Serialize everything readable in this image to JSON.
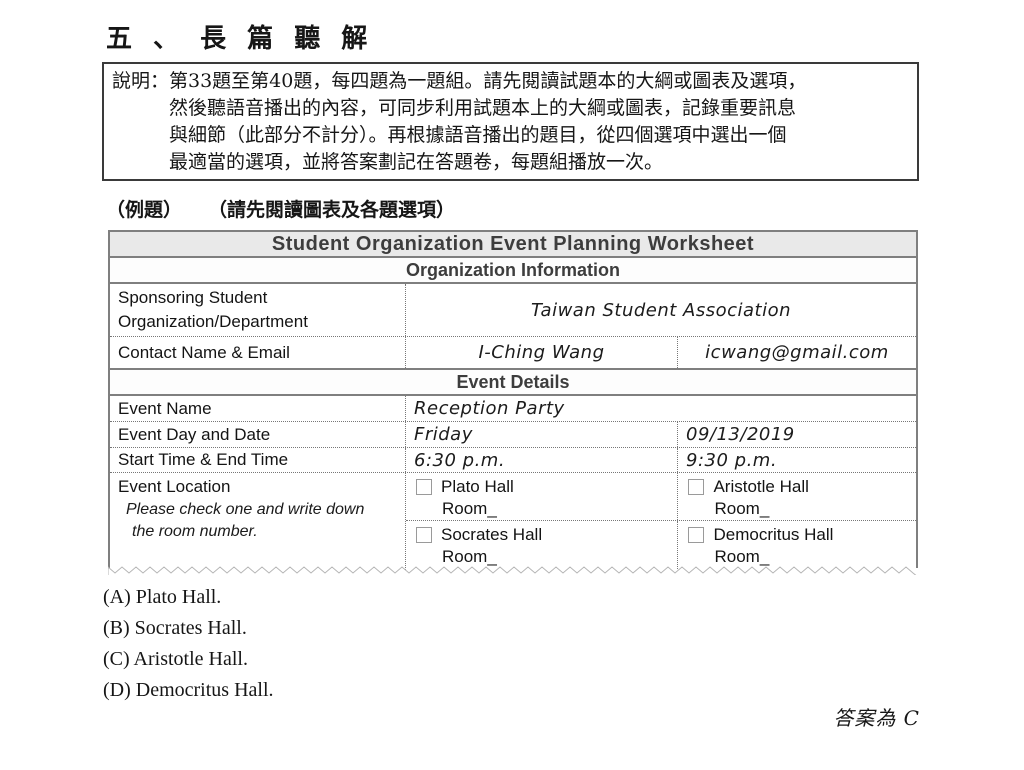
{
  "page": {
    "title": "五 、 長 篇 聽 解"
  },
  "instructions": {
    "lines": [
      "說明：第33題至第40題，每四題為一題組。請先閱讀試題本的大綱或圖表及選項，",
      "然後聽語音播出的內容，可同步利用試題本上的大綱或圖表，記錄重要訊息",
      "與細節（此部分不計分）。再根據語音播出的題目，從四個選項中選出一個",
      "最適當的選項，並將答案劃記在答題卷，每題組播放一次。"
    ]
  },
  "example": {
    "label": "（例題）",
    "note": "（請先閱讀圖表及各題選項）"
  },
  "worksheet": {
    "title": "Student Organization Event Planning Worksheet",
    "org_section": "Organization Information",
    "sponsoring_label": "Sponsoring Student Organization/Department",
    "sponsoring_value": "Taiwan Student Association",
    "contact_label": "Contact Name & Email",
    "contact_name": "I-Ching Wang",
    "contact_email": "icwang@gmail.com",
    "event_section": "Event Details",
    "event_name_label": "Event Name",
    "event_name_value": "Reception Party",
    "event_day_label": "Event Day and Date",
    "event_day_value": "Friday",
    "event_date_value": "09/13/2019",
    "time_label": "Start Time & End Time",
    "start_time": "6:30 p.m.",
    "end_time": "9:30 p.m.",
    "location_label": "Event Location",
    "location_note_1": "Please check one and write down",
    "location_note_2": "the room number.",
    "locations": [
      {
        "name": "Plato Hall",
        "room": "Room_",
        "checked": false
      },
      {
        "name": "Aristotle Hall",
        "room": "Room_",
        "checked": false
      },
      {
        "name": "Socrates Hall",
        "room": "Room_",
        "checked": false
      },
      {
        "name": "Democritus Hall",
        "room": "Room_",
        "checked": false
      }
    ]
  },
  "options": [
    "(A) Plato Hall.",
    "(B) Socrates Hall.",
    "(C) Aristotle Hall.",
    "(D) Democritus Hall."
  ],
  "answer_note": "答案為 C",
  "colors": {
    "border_gray": "#7f7f7f",
    "header_bg": "#e9e9e9",
    "header_text": "#3d3d3d"
  }
}
